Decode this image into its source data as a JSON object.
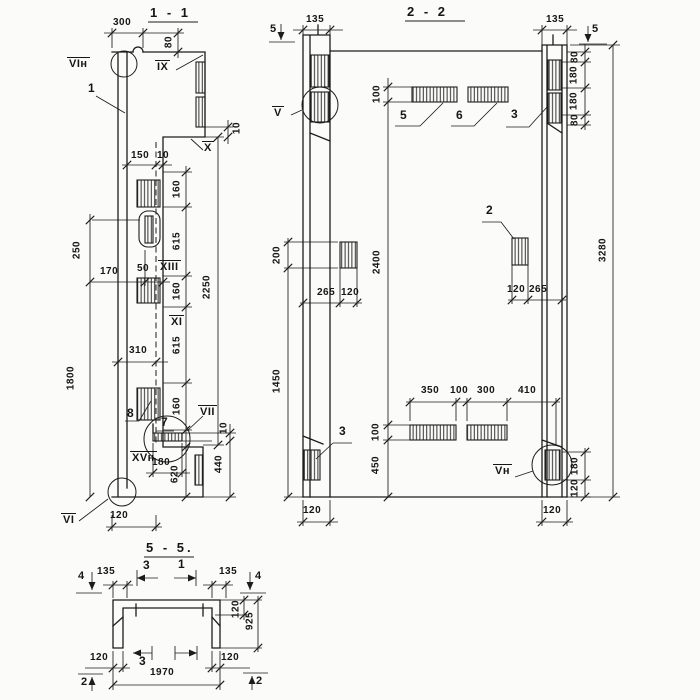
{
  "s1": {
    "title": "1 - 1",
    "marks": {
      "vi_n": "VIн",
      "ix": "IX",
      "x": "X",
      "xiii": "XIII",
      "xi": "XI",
      "vii": "VII",
      "xv_n": "XVн",
      "vi": "VI"
    },
    "pos": {
      "p1": "1",
      "p7": "7",
      "p8": "8"
    },
    "dims": {
      "w300": "300",
      "h80": "80",
      "d10_step": "10",
      "d150": "150",
      "d10": "10",
      "v250": "250",
      "h170": "170",
      "h50": "50",
      "v160a": "160",
      "v615a": "615",
      "v2250": "2250",
      "v160b": "160",
      "v615b": "615",
      "h310": "310",
      "v1800": "1800",
      "v160c": "160",
      "h180": "180",
      "v620": "620",
      "v440": "440",
      "d10c": "10",
      "w120": "120"
    }
  },
  "s2": {
    "title": "2 - 2",
    "cut5": "5",
    "marks": {
      "v": "V",
      "v_n": "Vн"
    },
    "pos": {
      "p5": "5",
      "p6": "6",
      "p3_top": "3",
      "p2": "2",
      "p3_bottom": "3"
    },
    "dims": {
      "l135": "135",
      "r135": "135",
      "v80a": "80",
      "v180a": "180",
      "v180b": "180",
      "v80b": "80",
      "v100_top": "100",
      "v200": "200",
      "v2400": "2400",
      "v3280": "3280",
      "l265": "265",
      "l120": "120",
      "r120": "120",
      "r265": "265",
      "v1450": "1450",
      "b350": "350",
      "b100": "100",
      "b300": "300",
      "b410": "410",
      "v100_bot": "100",
      "v450": "450",
      "v180_br": "180",
      "v120_br": "120",
      "bl120": "120",
      "br120": "120"
    }
  },
  "s5": {
    "title": "5 - 5.",
    "cut4": "4",
    "cut2": "2",
    "marks": {
      "m3_top": "3",
      "m1_top": "1",
      "m3_bottom": "3"
    },
    "dims": {
      "l135": "135",
      "r135": "135",
      "v120": "120",
      "v925": "925",
      "bl120": "120",
      "br120": "120",
      "w1970": "1970"
    }
  }
}
